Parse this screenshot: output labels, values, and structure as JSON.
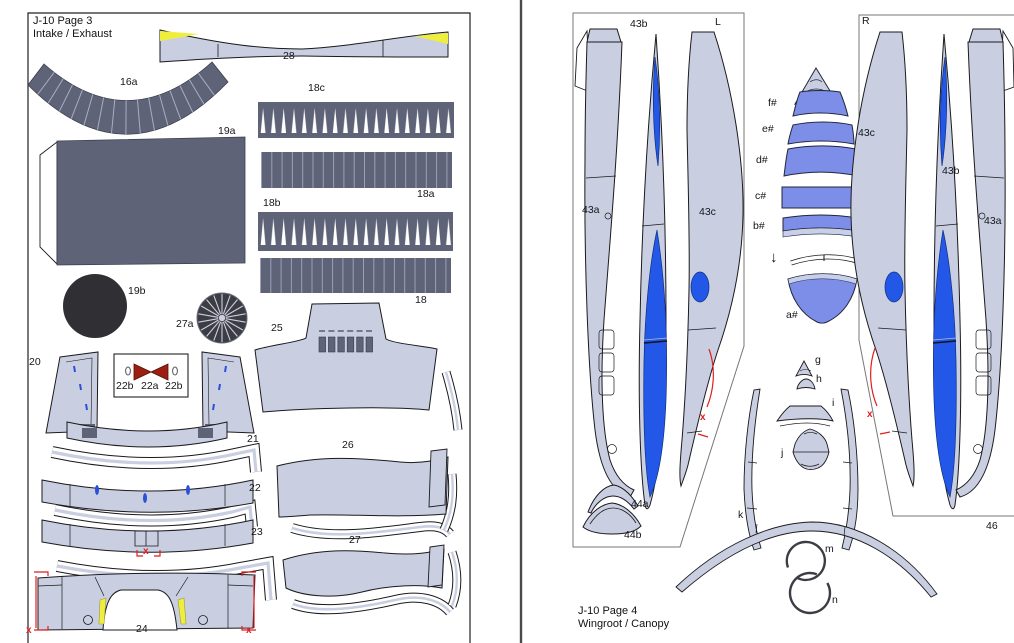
{
  "page3": {
    "title_line1": "J-10 Page 3",
    "title_line2": "Intake / Exhaust",
    "parts": {
      "p28": "28",
      "p16a": "16a",
      "p19a": "19a",
      "p18c": "18c",
      "p18a": "18a",
      "p18b": "18b",
      "p18": "18",
      "p19b": "19b",
      "p27a": "27a",
      "p25": "25",
      "p20": "20",
      "p22b": "22b",
      "p22a": "22a",
      "p21": "21",
      "p22": "22",
      "p23": "23",
      "p26": "26",
      "p27": "27",
      "p24": "24"
    },
    "marks": {
      "x": "x"
    }
  },
  "page4": {
    "title_line1": "J-10 Page 4",
    "title_line2": "Wingroot / Canopy",
    "side_left": "L",
    "side_right": "R",
    "arrow": "↓",
    "parts": {
      "p43a": "43a",
      "p43b": "43b",
      "p43c": "43c",
      "pf": "f#",
      "pe": "e#",
      "pd": "d#",
      "pc": "c#",
      "pb": "b#",
      "pa": "a#",
      "p44a": "44a",
      "p44b": "44b",
      "p46": "46",
      "pg": "g",
      "ph": "h",
      "pi": "i",
      "pj": "j",
      "pk": "k",
      "pm": "m",
      "pn": "n"
    },
    "marks": {
      "x": "x"
    }
  },
  "colors": {
    "piece_light": "#c9cfe1",
    "piece_dark": "#5e6377",
    "near_black": "#303034",
    "bright_blue": "#2257e8",
    "canopy_periwinkle": "#7d8ee9",
    "pale_edge": "#c8cfe8",
    "yellow_mark": "#f0ee3c",
    "red_annotation": "#e01f1f",
    "outline_ink": "#1a1a1e"
  }
}
